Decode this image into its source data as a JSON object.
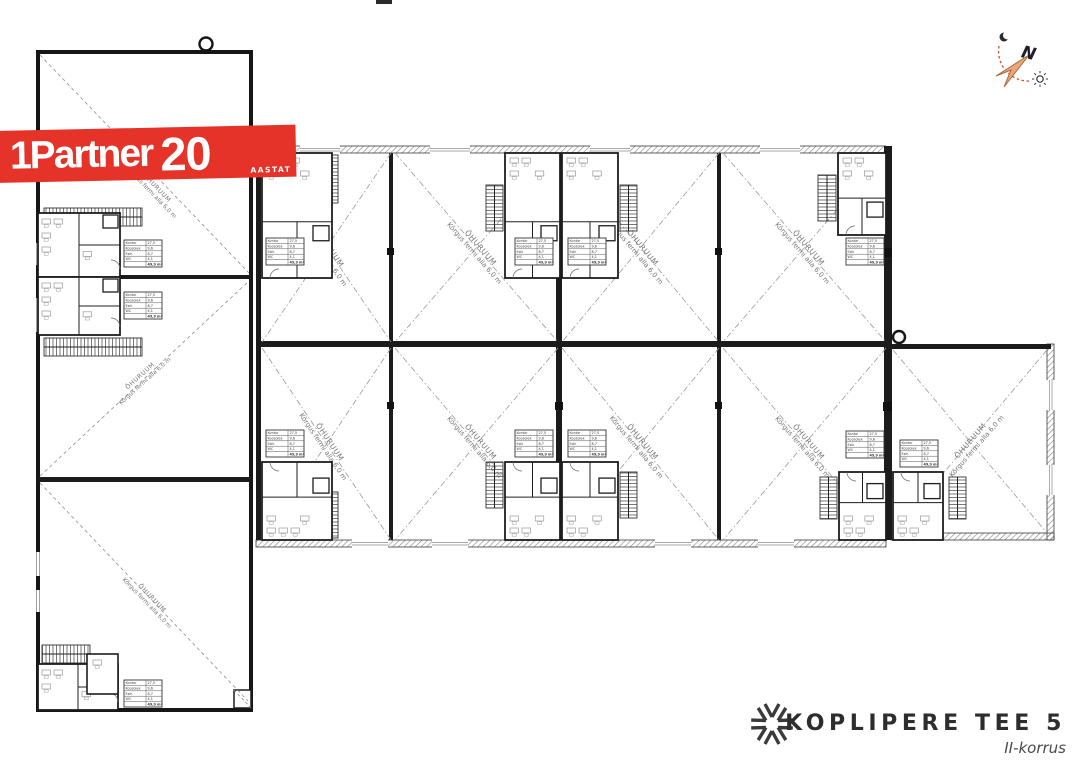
{
  "branding": {
    "logo_text": "1Partner",
    "anniversary_number": "20",
    "anniversary_label": "AASTAT"
  },
  "compass": {
    "north_label": "N"
  },
  "plan": {
    "air_room_label": "ÕHURUUM",
    "air_height_label": "Kõrgus fermi alla 6,0 m",
    "area_table": {
      "rows": [
        {
          "label": "Kontor",
          "value": "27,5"
        },
        {
          "label": "Koosolek",
          "value": "9,6"
        },
        {
          "label": "Esik",
          "value": "8,7"
        },
        {
          "label": "WC",
          "value": "4,1"
        },
        {
          "label": "",
          "value": "49,9 m²"
        }
      ]
    }
  },
  "footer": {
    "project_title": "KOPLIPERE TEE 5",
    "floor_label": "II-korrus"
  }
}
